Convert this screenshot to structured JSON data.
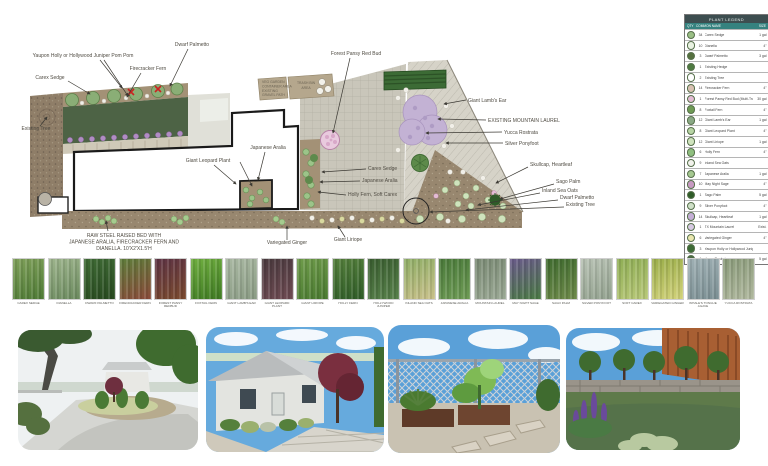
{
  "plan": {
    "labels": [
      {
        "t": "Yaupon Holly or Hollywood Juniper Pom Pom",
        "x": 83,
        "y": 57,
        "a": "middle",
        "lines": [
          [
            100,
            60,
            122,
            88
          ],
          [
            104,
            60,
            128,
            96
          ]
        ]
      },
      {
        "t": "Dwarf Palmetto",
        "x": 192,
        "y": 46,
        "a": "middle",
        "lines": [
          [
            188,
            49,
            170,
            86
          ]
        ]
      },
      {
        "t": "Firecracker Fern",
        "x": 148,
        "y": 70,
        "a": "middle",
        "lines": [
          [
            141,
            73,
            127,
            97
          ]
        ]
      },
      {
        "t": "Carex Sedge",
        "x": 50,
        "y": 79,
        "a": "middle",
        "lines": [
          [
            68,
            81,
            90,
            94
          ]
        ]
      },
      {
        "t": "Existing Tree",
        "x": 36,
        "y": 130,
        "a": "middle",
        "lines": [
          [
            40,
            126,
            47,
            117
          ]
        ]
      },
      {
        "t": "Forest Pansy Red Bud",
        "x": 356,
        "y": 55,
        "a": "middle",
        "lines": [
          [
            350,
            58,
            333,
            133
          ]
        ]
      },
      {
        "t": "Giant Lamb's Ear",
        "x": 468,
        "y": 102,
        "a": "start",
        "lines": [
          [
            466,
            100,
            444,
            104
          ]
        ]
      },
      {
        "t": "EXISTING MOUNTAIN LAUREL",
        "x": 488,
        "y": 122,
        "a": "start",
        "lines": [
          [
            486,
            120,
            438,
            119
          ]
        ]
      },
      {
        "t": "Yucca Rostrata",
        "x": 504,
        "y": 134,
        "a": "start",
        "lines": [
          [
            502,
            132,
            426,
            133
          ]
        ]
      },
      {
        "t": "Silver Ponyfoot",
        "x": 505,
        "y": 145,
        "a": "start",
        "lines": [
          [
            503,
            143,
            446,
            143
          ]
        ]
      },
      {
        "t": "Skullcap, Heartleaf",
        "x": 530,
        "y": 166,
        "a": "start",
        "lines": [
          [
            528,
            167,
            496,
            183
          ]
        ]
      },
      {
        "t": "Sago Palm",
        "x": 556,
        "y": 183,
        "a": "start",
        "lines": [
          [
            554,
            184,
            500,
            199
          ]
        ]
      },
      {
        "t": "Inland Sea Oats",
        "x": 542,
        "y": 192,
        "a": "start",
        "lines": [
          [
            540,
            193,
            478,
            205
          ]
        ]
      },
      {
        "t": "Dwarf Palmetto",
        "x": 560,
        "y": 199,
        "a": "start",
        "lines": [
          [
            558,
            200,
            466,
            210
          ]
        ]
      },
      {
        "t": "Existing Tree",
        "x": 566,
        "y": 206,
        "a": "start",
        "lines": [
          [
            564,
            207,
            430,
            212
          ]
        ]
      },
      {
        "t": "Giant Leopard Plant",
        "x": 208,
        "y": 162,
        "a": "middle",
        "lines": [
          [
            214,
            165,
            236,
            184
          ],
          [
            240,
            162,
            252,
            186
          ]
        ]
      },
      {
        "t": "Japanese Aralia",
        "x": 268,
        "y": 149,
        "a": "middle",
        "lines": [
          [
            265,
            152,
            258,
            180
          ]
        ]
      },
      {
        "t": "Carex Sedge",
        "x": 368,
        "y": 170,
        "a": "start",
        "lines": [
          [
            366,
            169,
            322,
            172
          ]
        ]
      },
      {
        "t": "Japanese Aralia",
        "x": 362,
        "y": 182,
        "a": "start",
        "lines": [
          [
            360,
            181,
            320,
            182
          ]
        ]
      },
      {
        "t": "Holly Fern, Soft Carex",
        "x": 348,
        "y": 196,
        "a": "start",
        "lines": [
          [
            346,
            195,
            318,
            192
          ]
        ]
      },
      {
        "t": "Variegated Ginger",
        "x": 287,
        "y": 244,
        "a": "middle",
        "lines": [
          [
            287,
            240,
            287,
            226
          ]
        ]
      },
      {
        "t": "Giant Liriope",
        "x": 348,
        "y": 241,
        "a": "middle",
        "lines": [
          [
            345,
            237,
            338,
            226
          ]
        ]
      }
    ],
    "raised_bed_note": {
      "x": 124,
      "y": 237,
      "lines": [
        "RAW STEEL RAISED BED WITH",
        "JAPANESE ARALIA, FIRECRACKER FERN AND",
        "DIANELLA. 10'X2'X1.5'H"
      ],
      "arrow": [
        108,
        231,
        106,
        221
      ]
    },
    "trash_area": {
      "x": 306,
      "line1": "TRASH BIN",
      "line2": "AREA"
    },
    "garden_note": {
      "x": 262,
      "lines": [
        "VEG GARDEN",
        "CONTAINER AREA",
        "EXISTING",
        "GRAVEL PATH"
      ]
    }
  },
  "legend": {
    "title": "PLANT LEGEND",
    "col_qty": "QTY",
    "col_name": "COMMON NAME",
    "col_size": "SIZE",
    "rows": [
      {
        "qty": "34",
        "name": "Carex Sedge",
        "size": "1 gal",
        "icon": "#9abf85"
      },
      {
        "qty": "10",
        "name": "Dianella",
        "size": "4\"",
        "icon": "#e9f2e2"
      },
      {
        "qty": "3",
        "name": "Dwarf Palmetto",
        "size": "3 gal",
        "icon": "#55703f"
      },
      {
        "qty": "1",
        "name": "Existing Hedge",
        "size": "",
        "icon": "#4e7a41"
      },
      {
        "qty": "2",
        "name": "Existing Tree",
        "size": "",
        "icon": "#ffffff"
      },
      {
        "qty": "14",
        "name": "Firecracker Fern",
        "size": "4\"",
        "icon": "#d8c1b2"
      },
      {
        "qty": "1",
        "name": "Forest Pansy Red Bud (Multi-Trunk)",
        "size": "30 gal",
        "icon": "#e3bcd4"
      },
      {
        "qty": "8",
        "name": "Foxtail Fern",
        "size": "4\"",
        "icon": "#6f9b55"
      },
      {
        "qty": "12",
        "name": "Giant Lamb's Ear",
        "size": "1 gal",
        "icon": "#8aa985"
      },
      {
        "qty": "8",
        "name": "Giant Leopard Plant",
        "size": "4\"",
        "icon": "#b7d4a4"
      },
      {
        "qty": "12",
        "name": "Giant Liriope",
        "size": "1 gal",
        "icon": "#cfe3bd"
      },
      {
        "qty": "6",
        "name": "Holly Fern",
        "size": "4\"",
        "icon": "#8fbf7f"
      },
      {
        "qty": "9",
        "name": "Inland Sea Oats",
        "size": "",
        "icon": "#f2f2ec"
      },
      {
        "qty": "7",
        "name": "Japanese Aralia",
        "size": "1 gal",
        "icon": "#a5c890"
      },
      {
        "qty": "10",
        "name": "May Night Sage",
        "size": "4\"",
        "icon": "#c79ac2"
      },
      {
        "qty": "1",
        "name": "Sago Palm",
        "size": "5 gal",
        "icon": "#2f5c28"
      },
      {
        "qty": "9",
        "name": "Silver Ponyfoot",
        "size": "4\"",
        "icon": "#cfe0c8"
      },
      {
        "qty": "14",
        "name": "Skullcap, Heartleaf",
        "size": "1 gal",
        "icon": "#c4aed6"
      },
      {
        "qty": "1",
        "name": "TX Mountain Laurel",
        "size": "Exist.",
        "icon": "#d6c9e2"
      },
      {
        "qty": "6",
        "name": "Variegated Ginger",
        "size": "4\"",
        "icon": "#e9e6ae"
      },
      {
        "qty": "3",
        "name": "Yaupon Holly or Hollywood Juniper Pom Pom",
        "size": "",
        "icon": "#3c6b35"
      },
      {
        "qty": "1",
        "name": "Yucca Rostrata",
        "size": "5 gal",
        "icon": "#4a6b44"
      }
    ]
  },
  "thumbnails": [
    {
      "name": "CAREX SEDGE",
      "c1": "#7fa05a",
      "c2": "#4e7a35"
    },
    {
      "name": "DIANELLA",
      "c1": "#9db48c",
      "c2": "#6b8a5e"
    },
    {
      "name": "DWARF PALMETTO",
      "c1": "#3f6b35",
      "c2": "#27491f"
    },
    {
      "name": "FIRECRACKER FERN",
      "c1": "#5e7d3a",
      "c2": "#8a4a3a"
    },
    {
      "name": "FOREST PANSY REDBUD",
      "c1": "#5e3344",
      "c2": "#7a4a2e"
    },
    {
      "name": "FOXTAIL FERN",
      "c1": "#6fae3f",
      "c2": "#3f7a23"
    },
    {
      "name": "GIANT LAMB'S EAR",
      "c1": "#a9b8a2",
      "c2": "#8a9b84"
    },
    {
      "name": "GIANT LEOPARD PLANT",
      "c1": "#4a3a3e",
      "c2": "#6e4a52"
    },
    {
      "name": "GIANT LIRIOPE",
      "c1": "#6e9b4a",
      "c2": "#4a7a30"
    },
    {
      "name": "HOLLY FERN",
      "c1": "#55803c",
      "c2": "#2f5c28"
    },
    {
      "name": "HOLLYWOOD JUNIPER",
      "c1": "#3a5e30",
      "c2": "#57804a"
    },
    {
      "name": "INLAND SEA OATS",
      "c1": "#8fae66",
      "c2": "#c9c08a"
    },
    {
      "name": "JAPANESE ARALIA",
      "c1": "#4a7a3a",
      "c2": "#6e9b55"
    },
    {
      "name": "MOUNTAIN LAUREL",
      "c1": "#7a8a74",
      "c2": "#9aa894"
    },
    {
      "name": "MAY NIGHT SAGE",
      "c1": "#6a5a8a",
      "c2": "#4a7a44"
    },
    {
      "name": "SAGO PALM",
      "c1": "#3f6b2f",
      "c2": "#6e8a4a"
    },
    {
      "name": "SILVER PONYFOOT",
      "c1": "#b8c2b4",
      "c2": "#93a28f"
    },
    {
      "name": "SOFT CAREX",
      "c1": "#8fae55",
      "c2": "#b8c878"
    },
    {
      "name": "VARIEGATED GINGER",
      "c1": "#9bae4a",
      "c2": "#d2d27a"
    },
    {
      "name": "WHALE'S TONGUE AGAVE",
      "c1": "#9fb0b4",
      "c2": "#7b8f93"
    },
    {
      "name": "YUCCA ROSTRATA",
      "c1": "#8a9b7a",
      "c2": "#b0b89e"
    }
  ]
}
